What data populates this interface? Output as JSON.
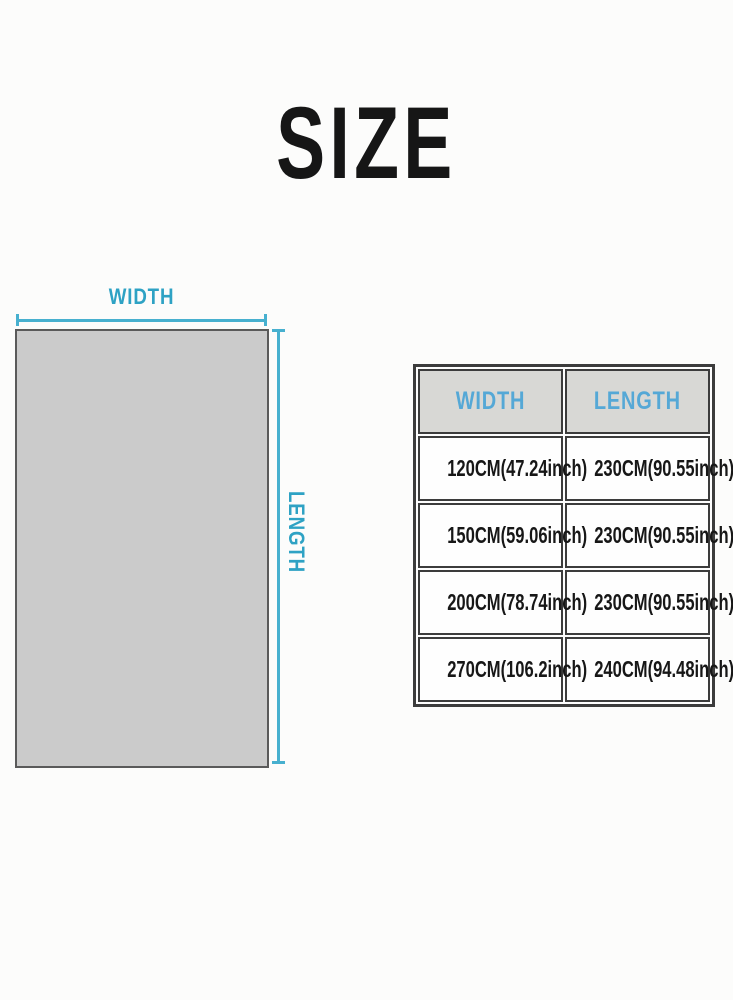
{
  "page": {
    "title": "SIZE"
  },
  "diagram": {
    "width_label": "WIDTH",
    "length_label": "LENGTH"
  },
  "size_table": {
    "headers": {
      "width": "WIDTH",
      "length": "LENGTH"
    },
    "rows": [
      [
        "120CM(47.24inch)",
        "230CM(90.55inch)"
      ],
      [
        "150CM(59.06inch)",
        "230CM(90.55inch)"
      ],
      [
        "200CM(78.74inch)",
        "230CM(90.55inch)"
      ],
      [
        "270CM(106.2inch)",
        "240CM(94.48inch)"
      ]
    ]
  },
  "colors": {
    "dimension_line": "#47b0cf",
    "diagram_label": "#2ea2c4",
    "table_header_text": "#55a8d6",
    "table_header_bg": "#d8d8d5",
    "table_border": "#3c3c3c",
    "rect_fill": "#cbcbcb",
    "rect_border": "#5a5a5a",
    "title_text": "#161616"
  }
}
